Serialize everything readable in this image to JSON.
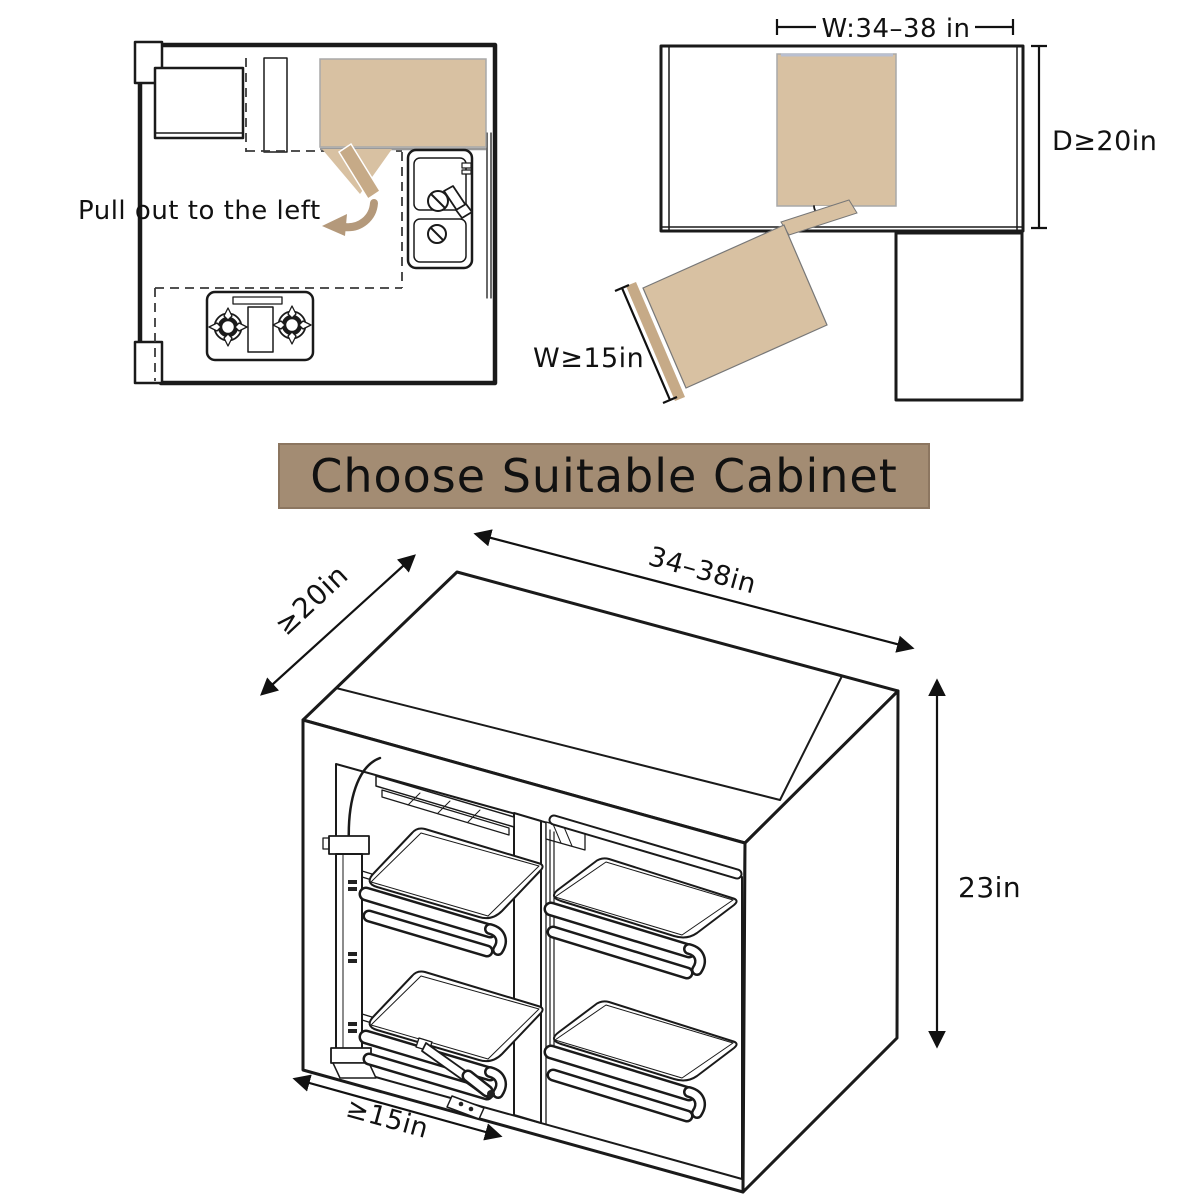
{
  "colors": {
    "tan": "#d8c1a2",
    "tan_dark": "#c6aa87",
    "arrow_tan": "#b4997b",
    "banner_bg": "#a38c73",
    "banner_border": "#8c7660",
    "line": "#1a1a1a",
    "shadow_blue": "#b9bfd0"
  },
  "floor_plan": {
    "callout": "Pull out to the left"
  },
  "clearance_diagram": {
    "width_label": "W:34–38 in",
    "depth_label": "D≥20in",
    "tray_width_label": "W≥15in"
  },
  "banner": {
    "title": "Choose Suitable Cabinet"
  },
  "cabinet_diagram": {
    "depth_label": "≥20in",
    "width_label": "34–38in",
    "height_label": "23in",
    "door_width_label": "≥15in"
  }
}
